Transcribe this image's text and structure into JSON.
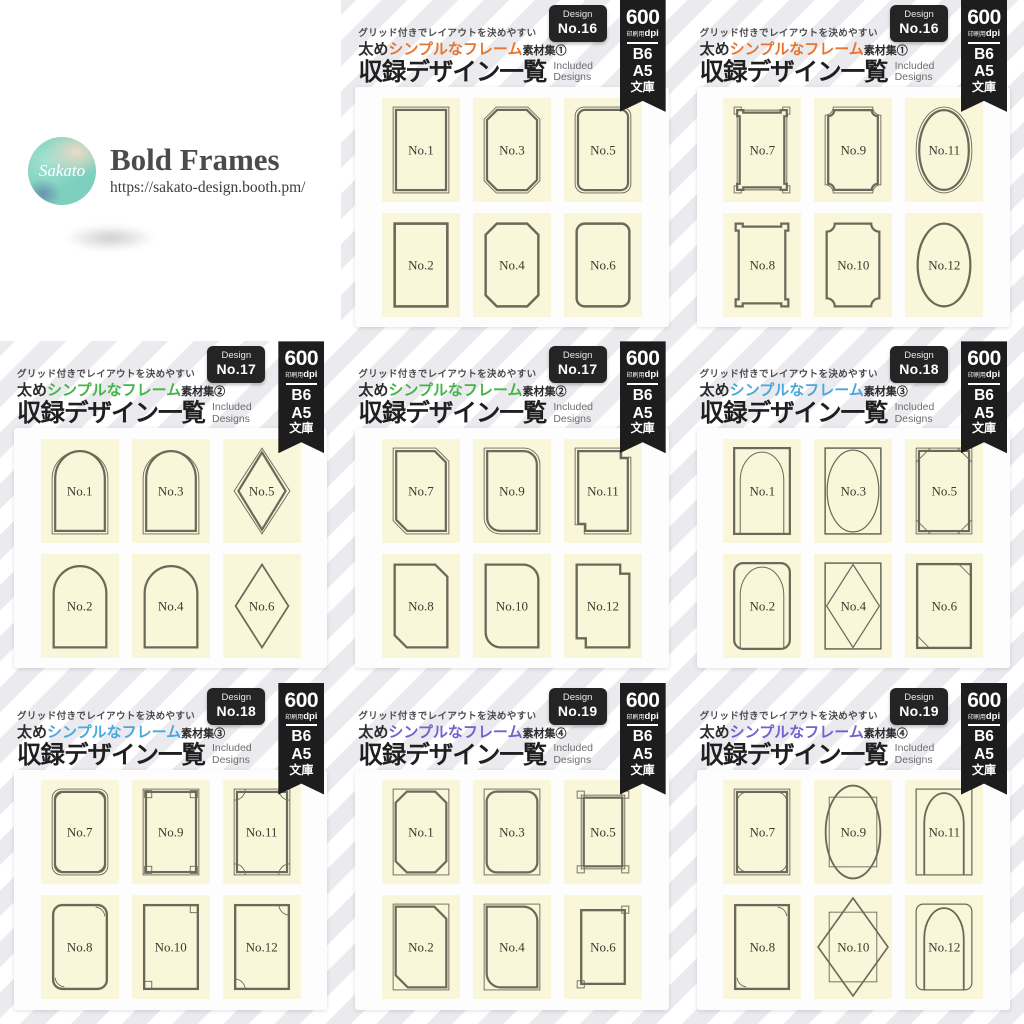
{
  "logo": {
    "brand": "Sakato",
    "title": "Bold Frames",
    "url": "https://sakato-design.booth.pm/"
  },
  "shared": {
    "tagline": "グリッド付きでレイアウトを決めやすい",
    "series_prefix": "太め",
    "series_accent": "シンプルなフレーム",
    "series_suffix": "素材集",
    "heading": "収録デザイン一覧",
    "heading_sub1": "Included",
    "heading_sub2": "Designs",
    "badge_label": "Design",
    "ribbon": {
      "dpi_big": "600",
      "dpi_unit_small": "印刷用",
      "dpi_unit": "dpi",
      "sizes": [
        "B6",
        "A5",
        "文庫"
      ]
    },
    "colors": {
      "frame_stroke": "#6b6a5a",
      "cell_bg": "#f9f6da",
      "ribbon_bg": "#1d1d1d",
      "badge_bg": "#242424"
    }
  },
  "panels": [
    {
      "design_no": "No.16",
      "set_no": "①",
      "accent": "#e8752e",
      "frames": [
        {
          "label": "No.1",
          "shape": "rect-d"
        },
        {
          "label": "No.3",
          "shape": "oct-d"
        },
        {
          "label": "No.5",
          "shape": "round-d"
        },
        {
          "label": "No.2",
          "shape": "rect-s"
        },
        {
          "label": "No.4",
          "shape": "oct-s"
        },
        {
          "label": "No.6",
          "shape": "round-s"
        }
      ]
    },
    {
      "design_no": "No.16",
      "set_no": "①",
      "accent": "#e8752e",
      "frames": [
        {
          "label": "No.7",
          "shape": "notch-d"
        },
        {
          "label": "No.9",
          "shape": "scallop-d"
        },
        {
          "label": "No.11",
          "shape": "ellipse-d"
        },
        {
          "label": "No.8",
          "shape": "notch-s"
        },
        {
          "label": "No.10",
          "shape": "scallop-s"
        },
        {
          "label": "No.12",
          "shape": "ellipse-s"
        }
      ]
    },
    {
      "design_no": "No.17",
      "set_no": "②",
      "accent": "#43b548",
      "frames": [
        {
          "label": "No.1",
          "shape": "arch-d"
        },
        {
          "label": "No.3",
          "shape": "arch-d"
        },
        {
          "label": "No.5",
          "shape": "diamond-d"
        },
        {
          "label": "No.2",
          "shape": "arch-s"
        },
        {
          "label": "No.4",
          "shape": "arch-s"
        },
        {
          "label": "No.6",
          "shape": "diamond-s"
        }
      ]
    },
    {
      "design_no": "No.17",
      "set_no": "②",
      "accent": "#43b548",
      "frames": [
        {
          "label": "No.7",
          "shape": "cut-d"
        },
        {
          "label": "No.9",
          "shape": "roundc-d"
        },
        {
          "label": "No.11",
          "shape": "step-d"
        },
        {
          "label": "No.8",
          "shape": "cut-s"
        },
        {
          "label": "No.10",
          "shape": "roundc-s"
        },
        {
          "label": "No.12",
          "shape": "step-s"
        }
      ]
    },
    {
      "design_no": "No.18",
      "set_no": "③",
      "accent": "#49a8dc",
      "frames": [
        {
          "label": "No.1",
          "shape": "rect-arch"
        },
        {
          "label": "No.3",
          "shape": "rect-ellipse"
        },
        {
          "label": "No.5",
          "shape": "cornerdiag-4"
        },
        {
          "label": "No.2",
          "shape": "round-arch"
        },
        {
          "label": "No.4",
          "shape": "rect-diamond"
        },
        {
          "label": "No.6",
          "shape": "cornerdiag-2"
        }
      ]
    },
    {
      "design_no": "No.18",
      "set_no": "③",
      "accent": "#49a8dc",
      "frames": [
        {
          "label": "No.7",
          "shape": "qround-4"
        },
        {
          "label": "No.9",
          "shape": "sq-4"
        },
        {
          "label": "No.11",
          "shape": "qcirc-4"
        },
        {
          "label": "No.8",
          "shape": "qround-2"
        },
        {
          "label": "No.10",
          "shape": "sq-2"
        },
        {
          "label": "No.12",
          "shape": "qcirc-2"
        }
      ]
    },
    {
      "design_no": "No.19",
      "set_no": "④",
      "accent": "#6f63d2",
      "frames": [
        {
          "label": "No.1",
          "shape": "octtri-4"
        },
        {
          "label": "No.3",
          "shape": "roundsq-4"
        },
        {
          "label": "No.5",
          "shape": "tab-4"
        },
        {
          "label": "No.2",
          "shape": "cuttri-2"
        },
        {
          "label": "No.4",
          "shape": "roundsq-2"
        },
        {
          "label": "No.6",
          "shape": "tab-2"
        }
      ]
    },
    {
      "design_no": "No.19",
      "set_no": "④",
      "accent": "#6f63d2",
      "frames": [
        {
          "label": "No.7",
          "shape": "bracket-4"
        },
        {
          "label": "No.9",
          "shape": "ellipse-over"
        },
        {
          "label": "No.11",
          "shape": "arch-in"
        },
        {
          "label": "No.8",
          "shape": "bracket-2"
        },
        {
          "label": "No.10",
          "shape": "diamond-over"
        },
        {
          "label": "No.12",
          "shape": "arch-in-r"
        }
      ]
    }
  ]
}
